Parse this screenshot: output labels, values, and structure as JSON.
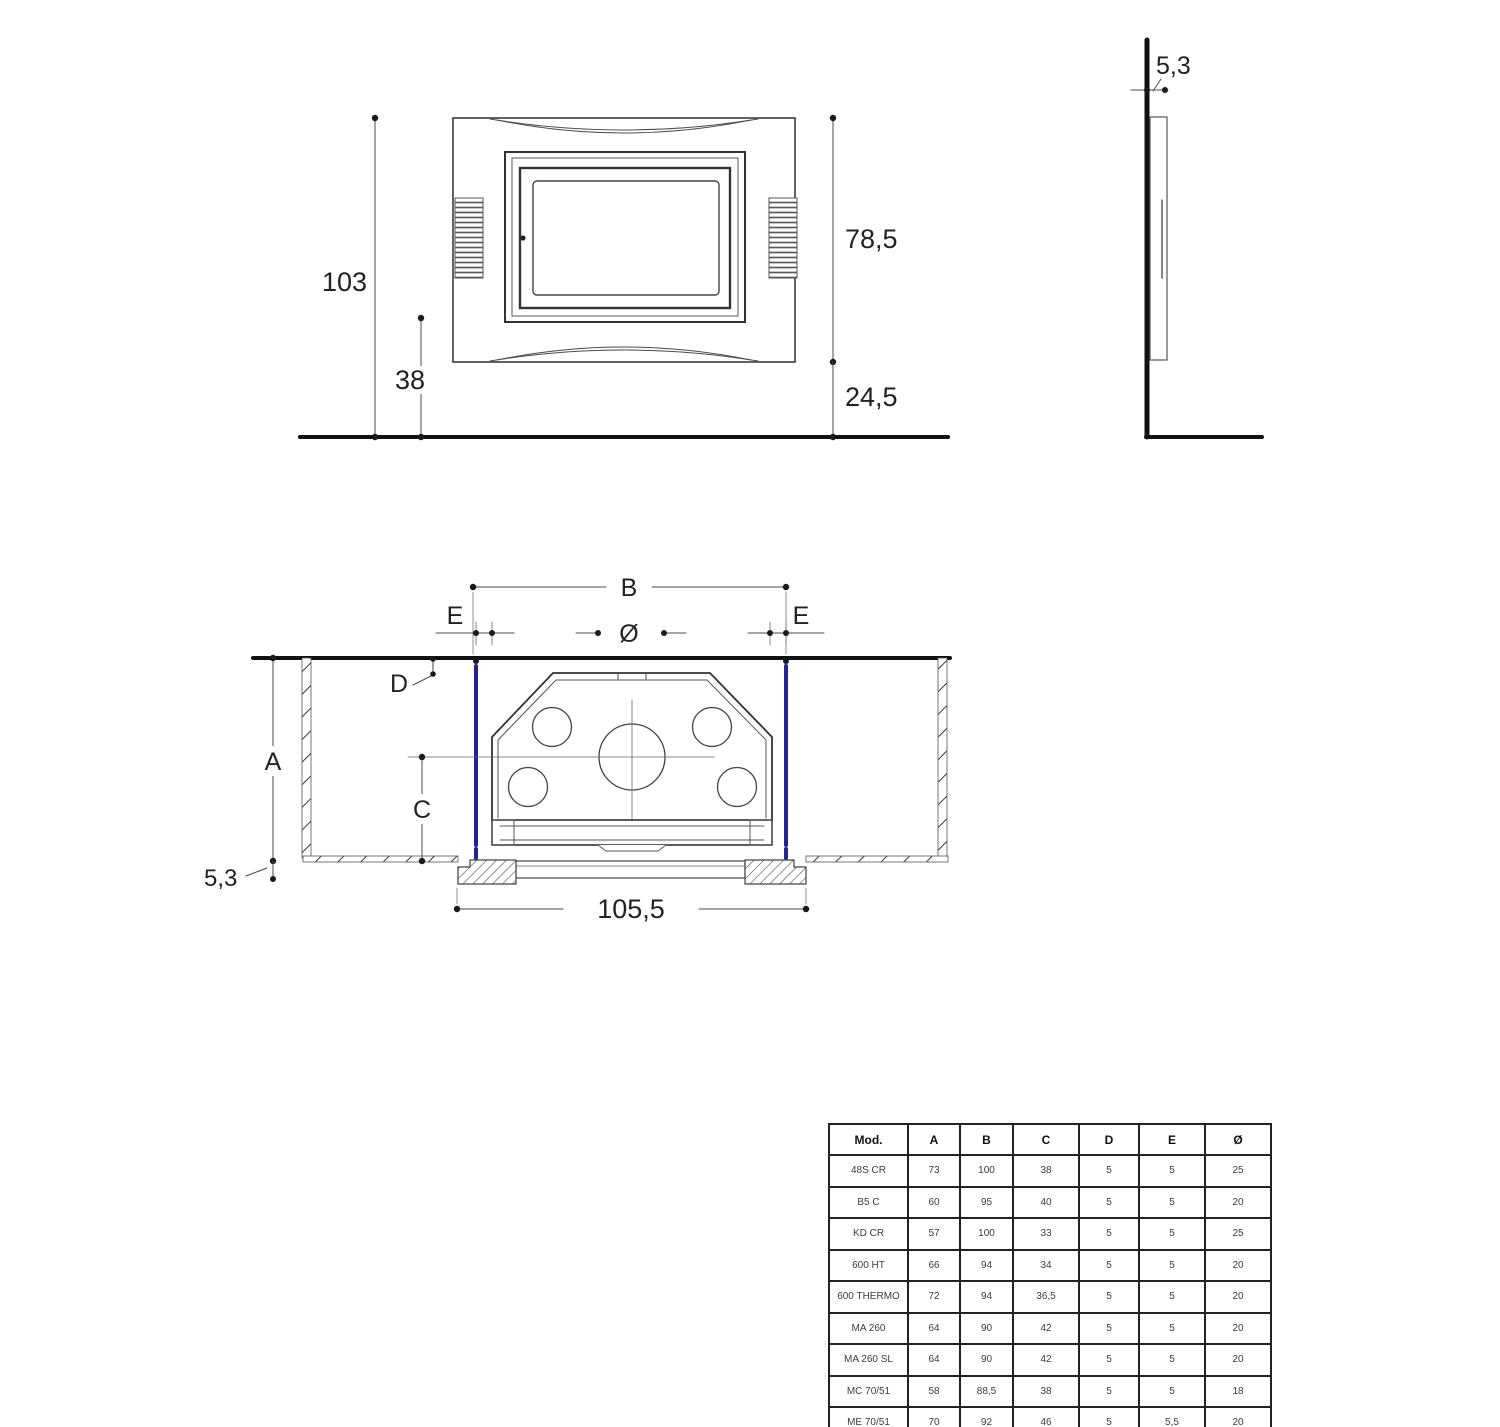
{
  "front_view": {
    "total_height": "103",
    "lower_height": "38",
    "frame_height": "78,5",
    "frame_bottom_height": "24,5"
  },
  "side_view": {
    "panel_thickness": "5,3"
  },
  "section_view": {
    "width_b": "B",
    "gap_left": "E",
    "gap_right": "E",
    "flue_diameter": "Ø",
    "depth_d": "D",
    "height_a": "A",
    "height_c": "C",
    "base_depth": "5,3",
    "overall_width": "105,5"
  },
  "table": {
    "headers": [
      "Mod.",
      "A",
      "B",
      "C",
      "D",
      "E",
      "Ø"
    ],
    "rows": [
      [
        "48S CR",
        "73",
        "100",
        "38",
        "5",
        "5",
        "25"
      ],
      [
        "B5 C",
        "60",
        "95",
        "40",
        "5",
        "5",
        "20"
      ],
      [
        "KD CR",
        "57",
        "100",
        "33",
        "5",
        "5",
        "25"
      ],
      [
        "600 HT",
        "66",
        "94",
        "34",
        "5",
        "5",
        "20"
      ],
      [
        "600 THERMO",
        "72",
        "94",
        "36,5",
        "5",
        "5",
        "20"
      ],
      [
        "MA 260",
        "64",
        "90",
        "42",
        "5",
        "5",
        "20"
      ],
      [
        "MA 260 SL",
        "64",
        "90",
        "42",
        "5",
        "5",
        "20"
      ],
      [
        "MC 70/51",
        "58",
        "88,5",
        "38",
        "5",
        "5",
        "18"
      ],
      [
        "ME 70/51",
        "70",
        "92",
        "46",
        "5",
        "5,5",
        "20"
      ]
    ]
  },
  "colors": {
    "accent_blue": "#22229a",
    "line_dark": "#222222"
  }
}
